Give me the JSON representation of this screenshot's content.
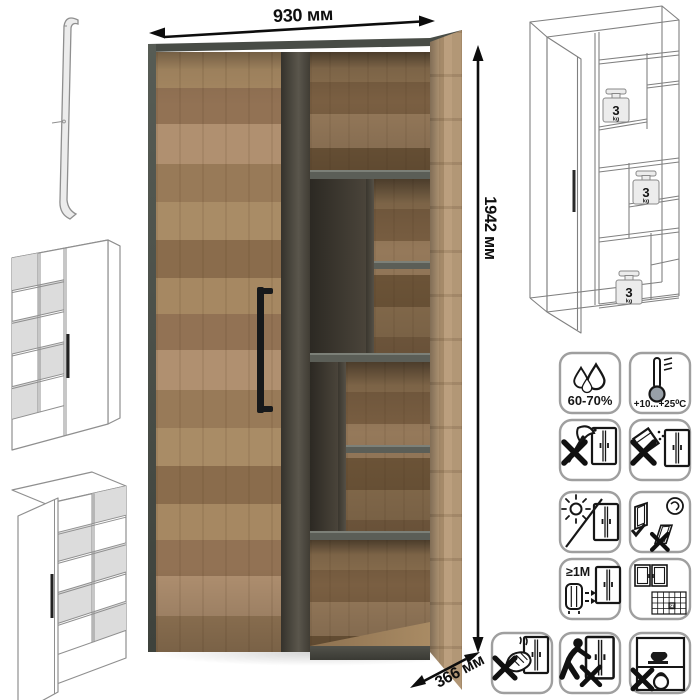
{
  "dimensions": {
    "width": "930 мм",
    "height": "1942 мм",
    "depth": "366 мм"
  },
  "weight_badge": {
    "value": "3",
    "unit": "kg"
  },
  "care": {
    "humidity": "60-70%",
    "temperature": "+10...+25⁰C",
    "min_distance": "≥1М",
    "calendar_day": "21"
  },
  "colors": {
    "wood_light": "#b09374",
    "wood_mid": "#9a7c5c",
    "wood_dark": "#806343",
    "frame_dark": "#474b45",
    "shelf_edge": "#5b5e57",
    "handle_black": "#17191b",
    "sketch_line": "#8f8f8f",
    "dimension_black": "#0e0e0e",
    "icon_line": "#161616",
    "icon_border": "#9f9f9f"
  }
}
